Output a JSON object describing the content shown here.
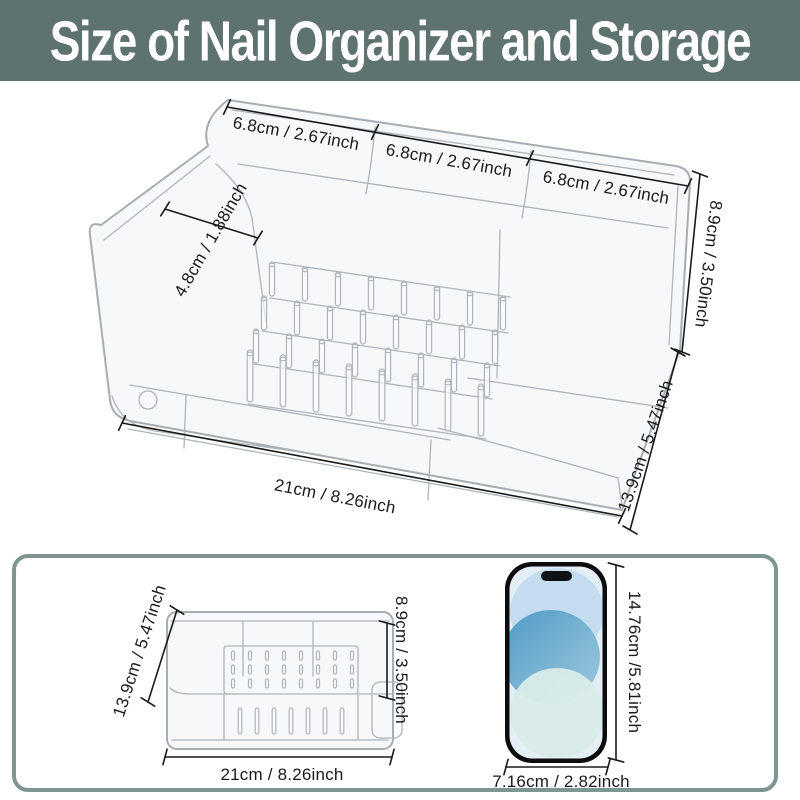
{
  "header": {
    "title": "Size of Nail Organizer and Storage"
  },
  "colors": {
    "header_bg": "#5e7370",
    "panel_border": "#7e9593",
    "dimension": "#1a1a1a",
    "acrylic": "#aeb5ba",
    "phone_frame": "#0c0c0e",
    "phone_screen": "#e4eef5",
    "blob_light": "#c3ddee",
    "blob_mid": "#5da4cb",
    "blob_pale": "#d8ebe9"
  },
  "main_view": {
    "description": "clear acrylic nail organizer, 3d perspective view with dimension lines",
    "dimensions": {
      "slot1_width": "6.8cm / 2.67inch",
      "slot2_width": "6.8cm / 2.67inch",
      "slot3_width": "6.8cm / 2.67inch",
      "left_depth": "4.8cm / 1.88inch",
      "height": "8.9cm / 3.50inch",
      "side_depth": "13.9cm / 5.47inch",
      "front_width": "21cm / 8.26inch"
    }
  },
  "comparison_panel": {
    "organizer_front": {
      "depth": "13.9cm / 5.47inch",
      "height": "8.9cm / 3.50inch",
      "width": "21cm / 8.26inch"
    },
    "phone": {
      "height": "14.76cm /5.81inch",
      "width": "7.16cm / 2.82inch"
    }
  }
}
